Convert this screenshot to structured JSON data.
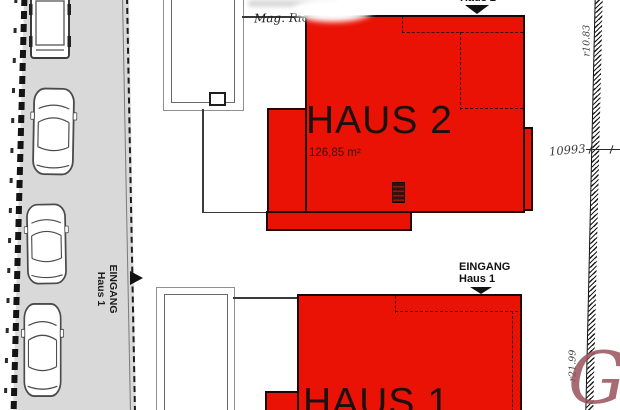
{
  "plan_title": "Site plan Haus 1 / Haus 2",
  "colors": {
    "house_red": "#ea1205",
    "road_gray": "#d9d9d9",
    "watermark": "#9a525c"
  },
  "road": {
    "label_line1": "EINGANG",
    "label_line2": "Haus 1"
  },
  "haus2": {
    "name": "HAUS 2",
    "area": "126,85 m²",
    "entrance_label": "Haus 2"
  },
  "haus1": {
    "name": "HAUS 1",
    "entrance_line1": "EINGANG",
    "entrance_line2": "Haus 1"
  },
  "annotations": {
    "architect": "Mag. Ric",
    "dim_top_right": "r10.83",
    "dim_mid_right": "10993",
    "dim_bottom_right": "r21.99",
    "watermark_letter": "G"
  }
}
